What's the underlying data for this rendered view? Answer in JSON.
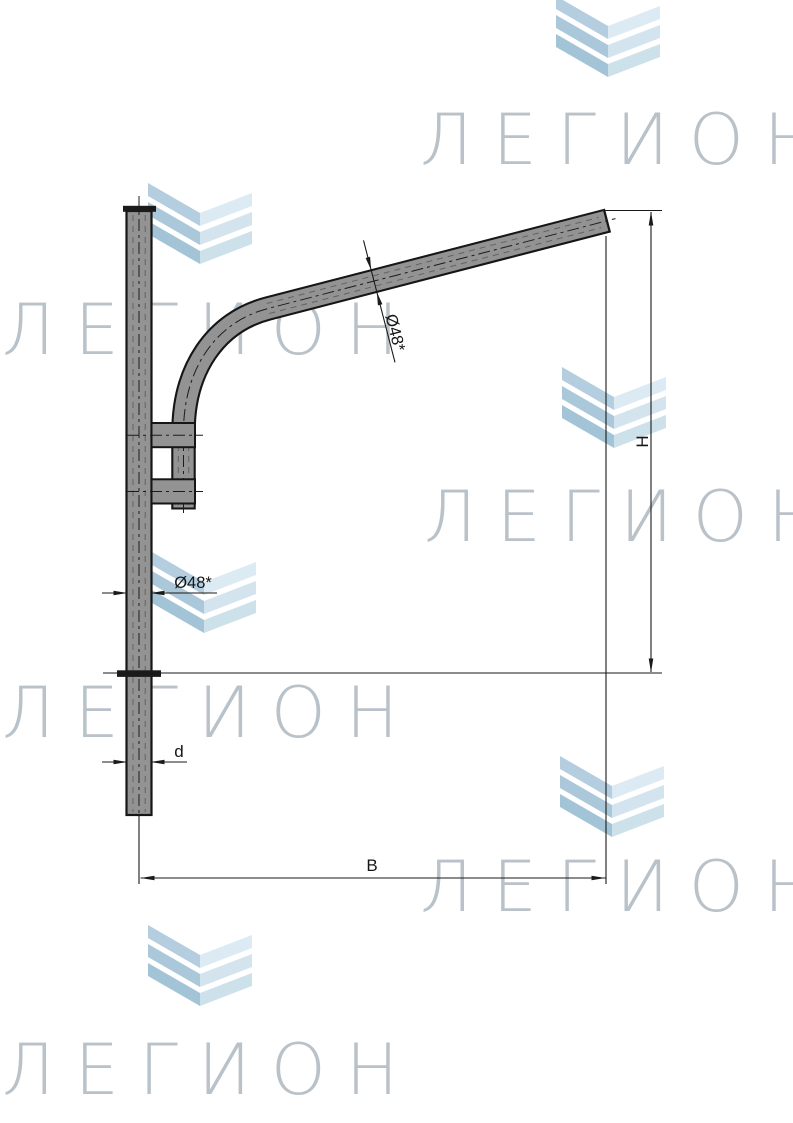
{
  "drawing": {
    "title": "bracket-technical-drawing",
    "dimensions": {
      "arm_diameter": "Ø48*",
      "post_diameter": "Ø48*",
      "pole_diameter": "d",
      "height": "H",
      "reach": "B"
    }
  },
  "watermark": {
    "text": "ЛЕГИОН",
    "color": "#b4bdc5"
  },
  "logo": {
    "name": "chevron-logo",
    "chevron_dark": "#a9c7d9",
    "chevron_light": "#d9e8f0"
  },
  "colors": {
    "background": "#ffffff",
    "pipe_fill": "#939393",
    "pipe_outline": "#161616",
    "fitting_dark": "#1b1b1b",
    "dimension_lines": "#1a1a1a"
  }
}
